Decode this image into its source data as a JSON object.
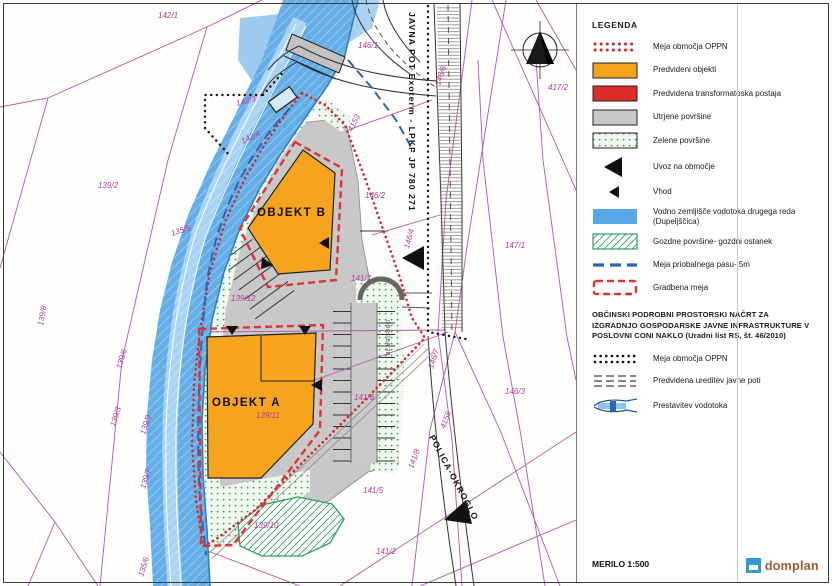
{
  "legend": {
    "title": "LEGENDA",
    "items": [
      {
        "type": "oppn-red-dots",
        "label": "Meja območja OPPN"
      },
      {
        "type": "orange-rect",
        "label": "Predvideni objekti"
      },
      {
        "type": "red-rect",
        "label": "Predvidena transformatoska postaja"
      },
      {
        "type": "gray-rect",
        "label": "Utrjene površine"
      },
      {
        "type": "green-dots-rect",
        "label": "Zelene površine"
      },
      {
        "type": "uvoz-triangle",
        "label": "Uvoz na območje"
      },
      {
        "type": "vhod-triangle",
        "label": "Vhod"
      },
      {
        "type": "blue-rect",
        "label": "Vodno zemljišče vodotoka  drugega reda",
        "label2": "(Dupeljščica)"
      },
      {
        "type": "forest-hatch-rect",
        "label": "Gozdne površine- gozdni ostanek"
      },
      {
        "type": "blue-dashed-line",
        "label": "Meja priobalnega pasu- 5m"
      },
      {
        "type": "red-dashed-outline",
        "label": "Gradbena meja"
      }
    ],
    "note": "OBČINSKI PODROBNI PROSTORSKI NAČRT  ZA IZGRADNJO GOSPODARSKE JAVNE INFRASTRUKTURE V POSLOVNI CONI NAKLO  (Uradni list RS, št. 46/2010)",
    "note_items": [
      {
        "type": "oppn-black-dots",
        "label": "Meja območja OPPN"
      },
      {
        "type": "path-dashes",
        "label": "Predvidena ureditev javne poti"
      },
      {
        "type": "watercourse",
        "label": "Prestavitev vodotoka"
      }
    ],
    "scale_label": "MERILO 1:500",
    "logo_text": "domplan"
  },
  "map": {
    "labels": [
      {
        "t": "OBJEKT B",
        "x": 257,
        "y": 216,
        "cls": "object"
      },
      {
        "t": "OBJEKT A",
        "x": 212,
        "y": 406,
        "cls": "object"
      },
      {
        "t": "JAVNA POT Exoterm - LPKF JP 780 271",
        "x": 409,
        "y": 12,
        "r": 90,
        "cls": "street"
      },
      {
        "t": "POLICA-OKROGLO",
        "x": 429,
        "y": 437,
        "r": 62,
        "cls": "street"
      },
      {
        "t": "OBROBA 2B",
        "x": 386,
        "y": 320,
        "r": 90,
        "cls": "small"
      },
      {
        "t": "142/1",
        "x": 158,
        "y": 18
      },
      {
        "t": "146/1",
        "x": 358,
        "y": 48
      },
      {
        "t": "417/2",
        "x": 548,
        "y": 90
      },
      {
        "t": "146/6",
        "x": 440,
        "y": 86,
        "r": -72
      },
      {
        "t": "4153",
        "x": 352,
        "y": 132,
        "r": -62
      },
      {
        "t": "142/3",
        "x": 237,
        "y": 106,
        "r": -15
      },
      {
        "t": "142/4",
        "x": 243,
        "y": 144,
        "r": -28
      },
      {
        "t": "139/2",
        "x": 98,
        "y": 188
      },
      {
        "t": "135/5",
        "x": 172,
        "y": 236,
        "r": -18
      },
      {
        "t": "146/2",
        "x": 365,
        "y": 198
      },
      {
        "t": "147/1",
        "x": 505,
        "y": 248
      },
      {
        "t": "146/4",
        "x": 409,
        "y": 249,
        "r": -75
      },
      {
        "t": "141/7",
        "x": 351,
        "y": 281
      },
      {
        "t": "139/12",
        "x": 231,
        "y": 301
      },
      {
        "t": "146/7",
        "x": 433,
        "y": 369,
        "r": -72
      },
      {
        "t": "141/6",
        "x": 354,
        "y": 400
      },
      {
        "t": "146/3",
        "x": 505,
        "y": 394
      },
      {
        "t": "139/11",
        "x": 256,
        "y": 418
      },
      {
        "t": "4156",
        "x": 445,
        "y": 429,
        "r": -70
      },
      {
        "t": "141/8",
        "x": 413,
        "y": 469,
        "r": -70
      },
      {
        "t": "141/5",
        "x": 363,
        "y": 493
      },
      {
        "t": "139/10",
        "x": 254,
        "y": 528
      },
      {
        "t": "141/2",
        "x": 376,
        "y": 554
      },
      {
        "t": "139/6",
        "x": 121,
        "y": 369,
        "r": -72
      },
      {
        "t": "139/3",
        "x": 115,
        "y": 427,
        "r": -72
      },
      {
        "t": "139/9",
        "x": 145,
        "y": 435,
        "r": -72
      },
      {
        "t": "139/7",
        "x": 145,
        "y": 489,
        "r": -72
      },
      {
        "t": "135/6",
        "x": 143,
        "y": 577,
        "r": -72
      },
      {
        "t": "139/8",
        "x": 43,
        "y": 326,
        "r": -80
      }
    ]
  },
  "colors": {
    "river_blue": "#64AEE8",
    "object_orange": "#F6A41E",
    "oppn_red": "#D7262C",
    "gradbena_red": "#E23333",
    "cadastral_magenta": "#B5399B",
    "priobalni_blue": "#2A66B8",
    "green": "#37A24E",
    "paved_gray": "#C8C8C8",
    "transformer_red": "#E02B2B",
    "logo_blue": "#2E9AD8",
    "logo_text_color": "#A6572E"
  }
}
